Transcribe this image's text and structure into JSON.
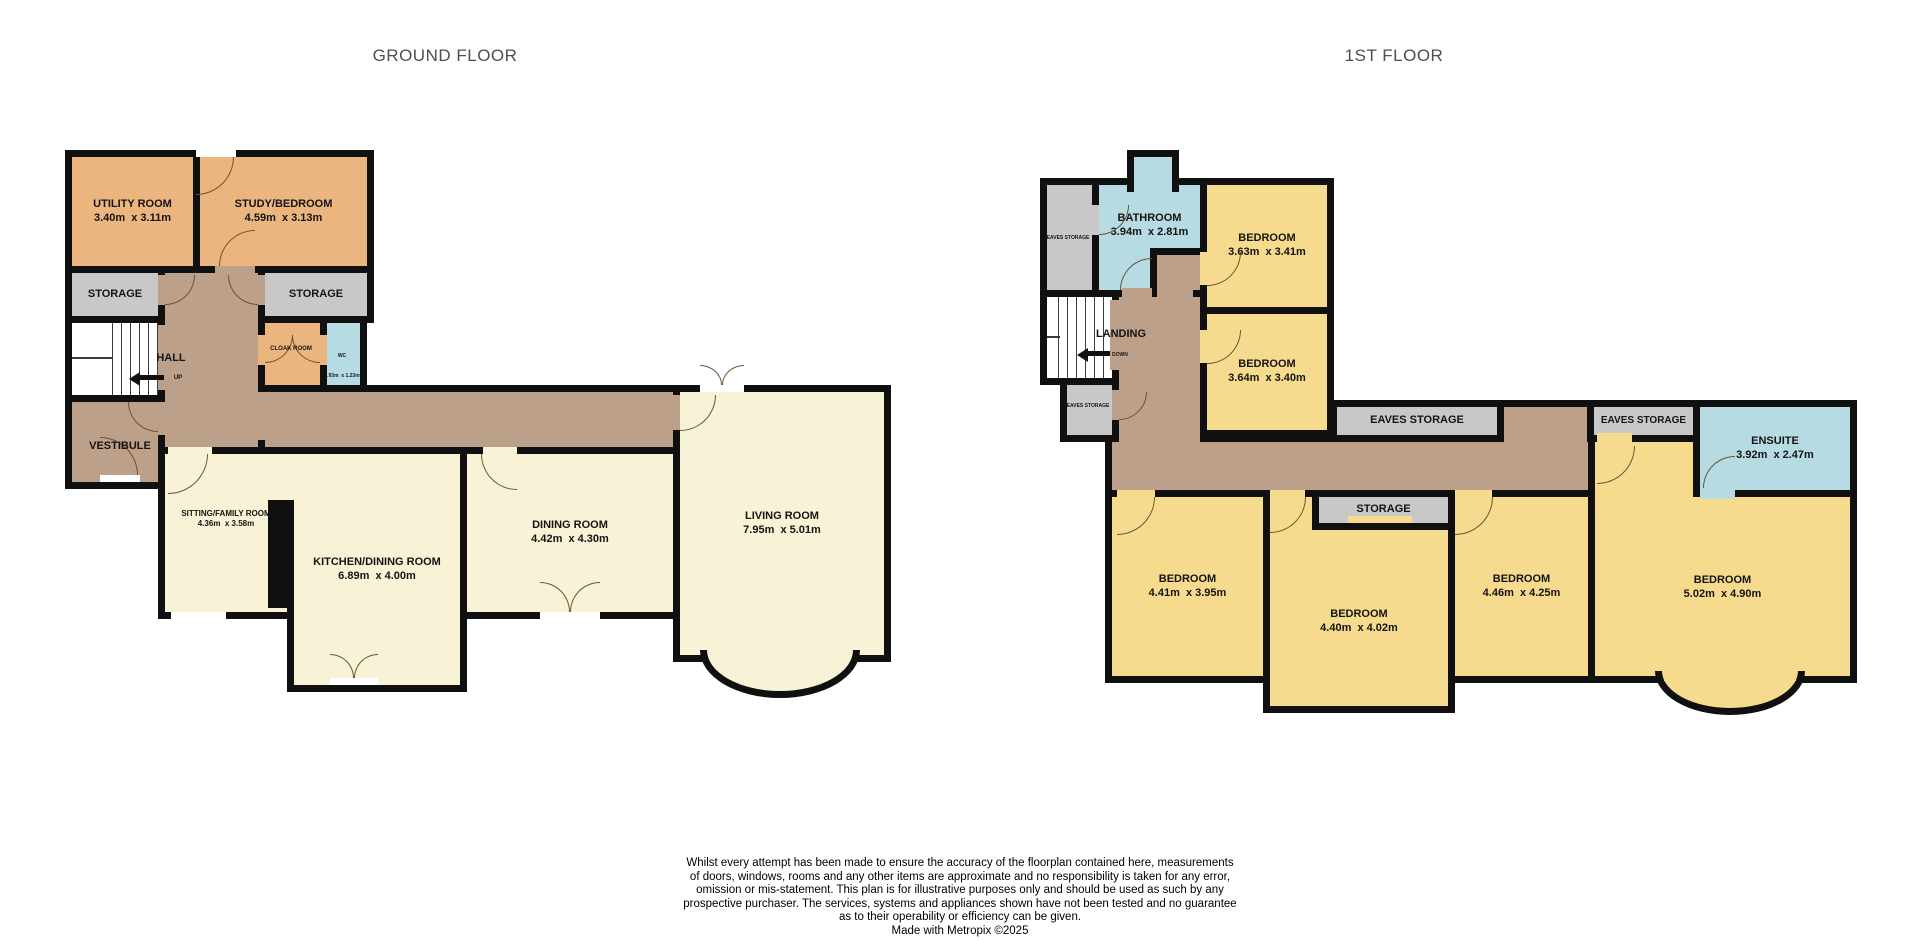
{
  "titles": {
    "ground_floor": "GROUND FLOOR",
    "first_floor": "1ST FLOOR"
  },
  "colors": {
    "room_tan": "#eab57f",
    "room_cream": "#f8f2d7",
    "room_yellow": "#f6db8e",
    "room_blue": "#b6dbe2",
    "storage_gray": "#c8c8c8",
    "corridor_brown": "#bda089",
    "wall": "#101010",
    "title_gray": "#4f4f4f"
  },
  "ground_floor": {
    "utility": {
      "name": "UTILITY ROOM",
      "dims": "3.40m  x 3.11m"
    },
    "study": {
      "name": "STUDY/BEDROOM",
      "dims": "4.59m  x 3.13m"
    },
    "storage_left": {
      "name": "STORAGE"
    },
    "storage_right": {
      "name": "STORAGE"
    },
    "hall": {
      "name": "HALL"
    },
    "stairs": {
      "direction": "UP"
    },
    "cloak": {
      "name": "CLOAK ROOM"
    },
    "wc": {
      "name": "WC",
      "dims": "1.93m  x 1.23m"
    },
    "vestibule": {
      "name": "VESTIBULE"
    },
    "sitting": {
      "name": "SITTING/FAMILY ROOM",
      "dims": "4.36m  x 3.58m"
    },
    "kitchen": {
      "name": "KITCHEN/DINING ROOM",
      "dims": "6.89m  x 4.00m"
    },
    "dining": {
      "name": "DINING ROOM",
      "dims": "4.42m  x 4.30m"
    },
    "living": {
      "name": "LIVING ROOM",
      "dims": "7.95m  x 5.01m"
    }
  },
  "first_floor": {
    "eaves_storage_top": {
      "name": "EAVES STORAGE"
    },
    "bathroom": {
      "name": "BATHROOM",
      "dims": "3.94m  x 2.81m"
    },
    "bedroom_1": {
      "name": "BEDROOM",
      "dims": "3.63m  x 3.41m"
    },
    "bedroom_2": {
      "name": "BEDROOM",
      "dims": "3.64m  x 3.40m"
    },
    "landing": {
      "name": "LANDING"
    },
    "stairs": {
      "direction": "DOWN"
    },
    "eaves_storage_mid": {
      "name": "EAVES STORAGE"
    },
    "eaves_storage_bar_left": {
      "name": "EAVES STORAGE"
    },
    "eaves_storage_bar_right": {
      "name": "EAVES STORAGE"
    },
    "ensuite": {
      "name": "ENSUITE",
      "dims": "3.92m  x 2.47m"
    },
    "storage": {
      "name": "STORAGE"
    },
    "bedroom_3": {
      "name": "BEDROOM",
      "dims": "4.41m  x 3.95m"
    },
    "bedroom_4": {
      "name": "BEDROOM",
      "dims": "4.40m  x 4.02m"
    },
    "bedroom_5": {
      "name": "BEDROOM",
      "dims": "4.46m  x 4.25m"
    },
    "bedroom_6": {
      "name": "BEDROOM",
      "dims": "5.02m  x 4.90m"
    }
  },
  "disclaimer": {
    "lines": [
      "Whilst every attempt has been made to ensure the accuracy of the floorplan contained here, measurements",
      "of doors, windows, rooms and any other items are approximate and no responsibility is taken for any error,",
      "omission or mis-statement. This plan is for illustrative purposes only and should be used as such by any",
      "prospective purchaser. The services, systems and appliances shown have not been tested and no guarantee",
      "as to their operability or efficiency can be given."
    ],
    "credit": "Made with Metropix ©2025"
  }
}
